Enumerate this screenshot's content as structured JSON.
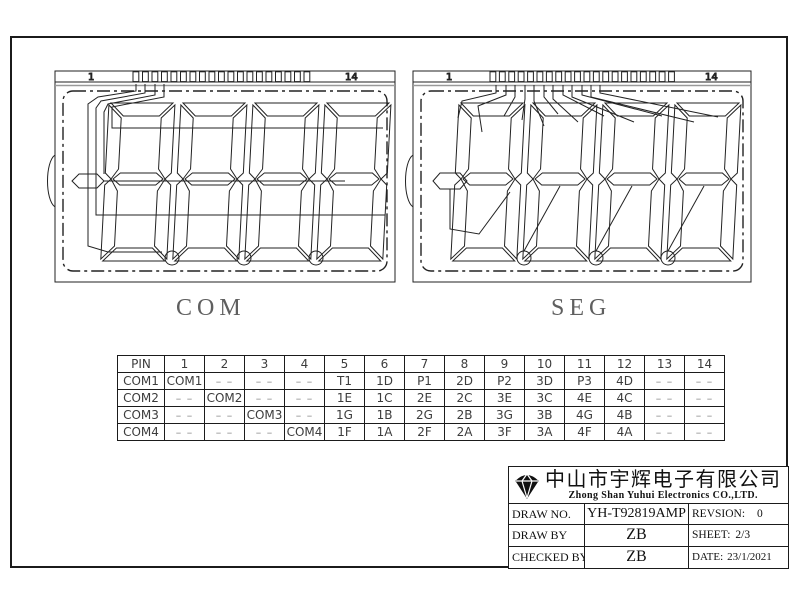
{
  "sheet": {
    "background": "#ffffff",
    "line_color": "#1b1b1b"
  },
  "com_display": {
    "caption": "COM",
    "pin_label_left": "1",
    "pin_label_right": "14",
    "trace_ticks": 19,
    "digits": 4,
    "decimal_points": 3
  },
  "seg_display": {
    "caption": "SEG",
    "pin_label_left": "1",
    "pin_label_right": "14",
    "trace_ticks": 20,
    "digits": 4,
    "decimal_points": 3
  },
  "pin_table": {
    "dash": "– –",
    "headers": [
      "PIN",
      "1",
      "2",
      "3",
      "4",
      "5",
      "6",
      "7",
      "8",
      "9",
      "10",
      "11",
      "12",
      "13",
      "14"
    ],
    "rows": [
      {
        "label": "COM1",
        "cells": [
          "COM1",
          "– –",
          "– –",
          "– –",
          "T1",
          "1D",
          "P1",
          "2D",
          "P2",
          "3D",
          "P3",
          "4D",
          "– –",
          "– –"
        ]
      },
      {
        "label": "COM2",
        "cells": [
          "– –",
          "COM2",
          "– –",
          "– –",
          "1E",
          "1C",
          "2E",
          "2C",
          "3E",
          "3C",
          "4E",
          "4C",
          "– –",
          "– –"
        ]
      },
      {
        "label": "COM3",
        "cells": [
          "– –",
          "– –",
          "COM3",
          "– –",
          "1G",
          "1B",
          "2G",
          "2B",
          "3G",
          "3B",
          "4G",
          "4B",
          "– –",
          "– –"
        ]
      },
      {
        "label": "COM4",
        "cells": [
          "– –",
          "– –",
          "– –",
          "COM4",
          "1F",
          "1A",
          "2F",
          "2A",
          "3F",
          "3A",
          "4F",
          "4A",
          "– –",
          "– –"
        ]
      }
    ]
  },
  "title_block": {
    "company_cn": "中山市宇辉电子有限公司",
    "company_en": "Zhong Shan Yuhui Electronics CO.,LTD.",
    "logo": "gem-icon",
    "rows": [
      {
        "label": "DRAW NO.",
        "value": "YH-T92819AMP",
        "right_label": "REVSION:",
        "right_value": "0"
      },
      {
        "label": "DRAW BY",
        "value": "ZB",
        "right_label": "SHEET:",
        "right_value": "2/3"
      },
      {
        "label": "CHECKED BY",
        "value": "ZB",
        "right_label": "DATE:",
        "right_value": "23/1/2021"
      }
    ]
  }
}
